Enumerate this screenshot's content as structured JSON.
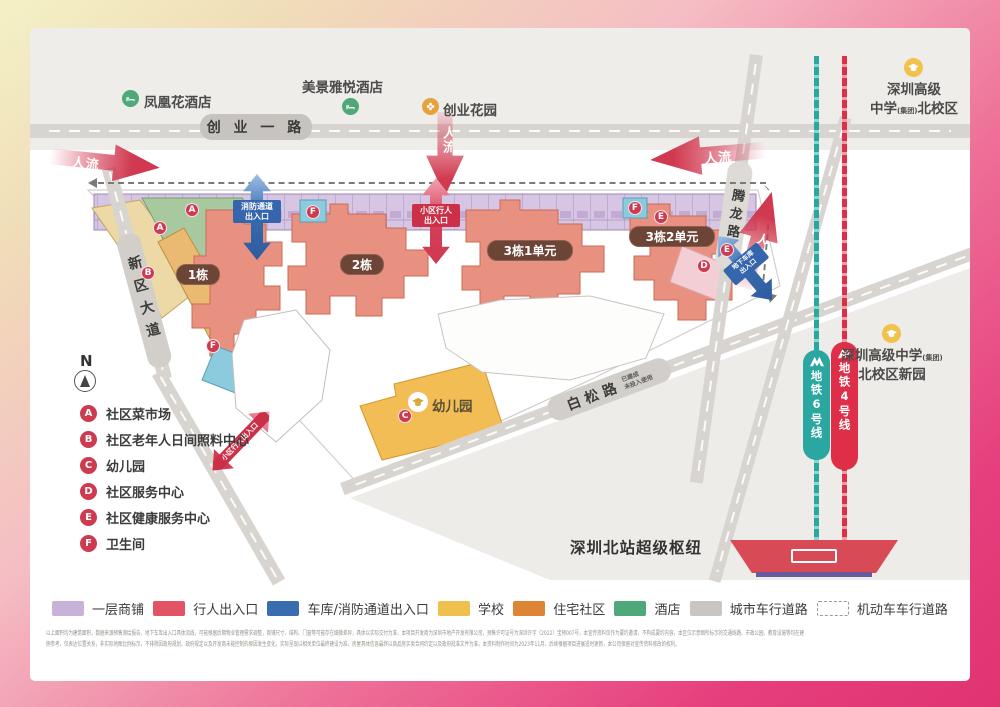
{
  "pois": {
    "hotel_phoenix": "凤凰花酒店",
    "hotel_meijing": "美景雅悦酒店",
    "garden_chuangye": "创业花园",
    "school_north": {
      "line1": "深圳高级",
      "line2_pre": "中学",
      "line2_small": "(集团)",
      "line2_post": "北校区"
    },
    "school_new": {
      "line1_pre": "深圳高级中学",
      "line1_small": "(集团)",
      "line2": "北校区新园"
    },
    "station_hub": "深圳北站超级枢纽"
  },
  "roads": {
    "chuangye_yi": "创 业 一 路",
    "xinqu": "新区大道",
    "baisong": "白松路",
    "baisong_note_1": "已建成",
    "baisong_note_2": "未投入使用",
    "tenglong": "腾龙路"
  },
  "metro": {
    "line6": "地铁6号线",
    "line4": "地铁4号线",
    "line6_color": "#2aa7a1",
    "line4_color": "#df2f48"
  },
  "buildings": {
    "b1": "1栋",
    "b2": "2栋",
    "b3u1": "3栋1单元",
    "b3u2": "3栋2单元",
    "kindergarten": "幼儿园"
  },
  "flow_label": "人流",
  "entrances": {
    "fire_l1": "消防通道",
    "fire_l2": "出入口",
    "ped_l1": "小区行人",
    "ped_l2": "出入口",
    "garage_l1": "地下车库",
    "garage_l2": "出入口",
    "ped_side": "小区行人出入口"
  },
  "compass": "N",
  "facilities": [
    {
      "key": "A",
      "label": "社区菜市场"
    },
    {
      "key": "B",
      "label": "社区老年人日间照料中心"
    },
    {
      "key": "C",
      "label": "幼儿园"
    },
    {
      "key": "D",
      "label": "社区服务中心"
    },
    {
      "key": "E",
      "label": "社区健康服务中心"
    },
    {
      "key": "F",
      "label": "卫生间"
    }
  ],
  "map_markers": [
    "A",
    "A",
    "B",
    "F",
    "F",
    "F",
    "E",
    "E",
    "D",
    "C"
  ],
  "legend": [
    {
      "label": "一层商铺",
      "color": "#c9b2d8",
      "type": "solid"
    },
    {
      "label": "行人出入口",
      "color": "#e25366",
      "type": "solid"
    },
    {
      "label": "车库/消防通道出入口",
      "color": "#3a6cb0",
      "type": "solid"
    },
    {
      "label": "学校",
      "color": "#f0c04e",
      "type": "solid"
    },
    {
      "label": "住宅社区",
      "color": "#dd8435",
      "type": "solid"
    },
    {
      "label": "酒店",
      "color": "#4fa878",
      "type": "solid"
    },
    {
      "label": "城市车行道路",
      "color": "#c9c6c2",
      "type": "solid"
    },
    {
      "label": "机动车车行道路",
      "color": "#9a9a9a",
      "type": "dashed"
    }
  ],
  "disclaimer": {
    "line1": "以上面积均为建筑面积，数据来源预售测绘报告，地下车库出入口具体流线，可能根据后期物业管理需求调整，商铺尺寸、结构、门窗等可能存在细微差异，具体以实际交付为准，本项目开发商为深圳市地产开发有限公司，预售许可证号为深圳许字（2022）宝预007号，本宣传资料仅作为要约邀请，不构成要约内容，本区位示意图所标示的交通线路、市政公园、教育设施等均在建",
    "line2": "侧参考，仅表达位置关系，非实际地图比例标示，不排除因政府规划、政府规定以及开发商未能控制的原因发生变化，实际呈现以相关单位最终建设为准，房屋具体信息最终以商品房买卖合同约定以及政府批准文件为准，本资料制作时间为2023年11月，后续根据项目进展适时更新，本公司保留对宣传资料修改的权利。"
  }
}
